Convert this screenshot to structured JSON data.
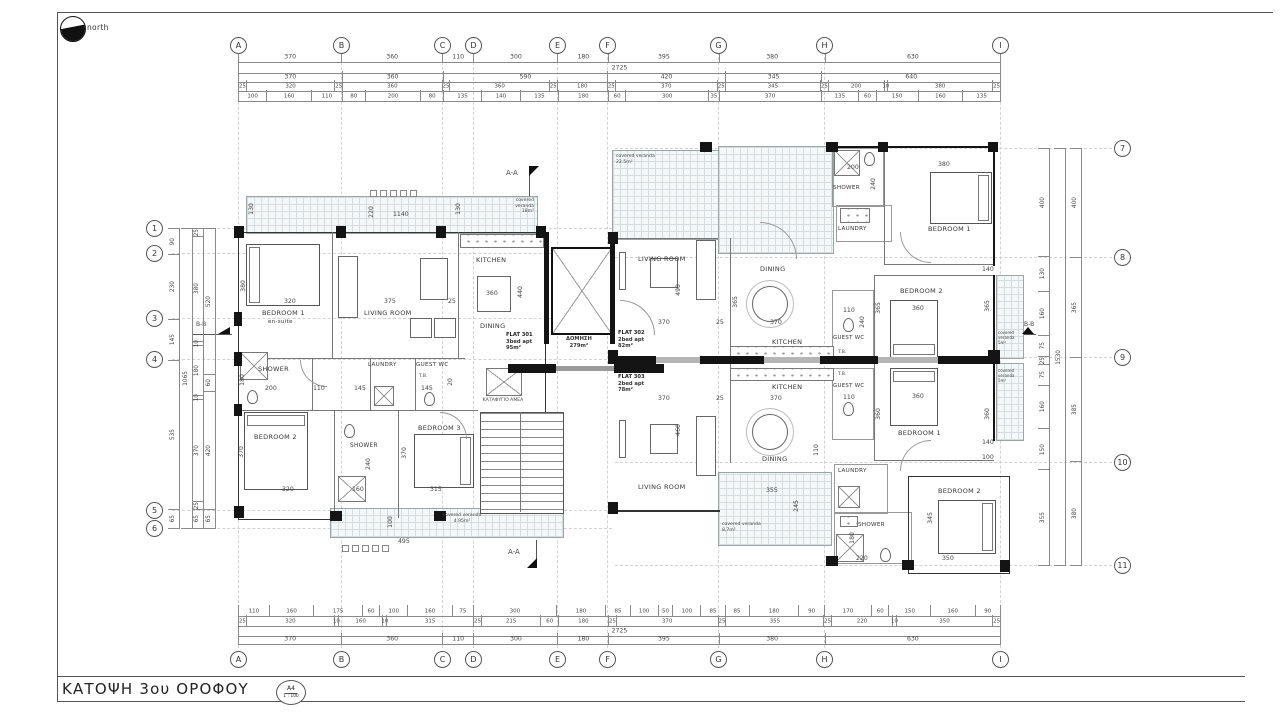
{
  "sheet": {
    "title": "ΚΑΤΟΨΗ 3ου ΟΡΟΦΟΥ",
    "paper": "A4",
    "scale": "1 : 100",
    "north": "north"
  },
  "grid": {
    "cols": [
      "A",
      "B",
      "C",
      "D",
      "E",
      "F",
      "G",
      "H",
      "I"
    ],
    "rows_left": [
      "1",
      "2",
      "3",
      "4",
      "5",
      "6"
    ],
    "rows_right": [
      "7",
      "8",
      "9",
      "10",
      "11"
    ]
  },
  "dims": {
    "top": {
      "grid": [
        370,
        360,
        110,
        300,
        180,
        395,
        380,
        630
      ],
      "overall": "2725",
      "chain2": [
        370,
        360,
        590,
        420,
        345,
        640
      ],
      "chain3": [
        25,
        320,
        25,
        360,
        25,
        360,
        25,
        180,
        25,
        370,
        25,
        345,
        25,
        200,
        10,
        380,
        25
      ],
      "chain4": [
        100,
        160,
        110,
        80,
        200,
        80,
        135,
        140,
        135,
        180,
        60,
        300,
        35,
        370,
        135,
        60,
        150,
        160,
        135
      ]
    },
    "bottom": {
      "chain1": [
        110,
        160,
        175,
        60,
        100,
        160,
        75,
        300,
        180,
        85,
        100,
        50,
        100,
        85,
        85,
        180,
        90,
        170,
        60,
        150,
        160,
        90
      ],
      "chain2": [
        25,
        320,
        10,
        160,
        10,
        315,
        25,
        215,
        60,
        180,
        25,
        370,
        25,
        355,
        25,
        220,
        10,
        350,
        25
      ],
      "overall": "2725",
      "grid": [
        370,
        360,
        110,
        300,
        180,
        395,
        380,
        630
      ]
    },
    "left": {
      "outer": [
        90,
        230,
        145,
        535,
        65
      ],
      "overall": "1065",
      "mid": [
        25,
        380,
        10,
        180,
        10,
        370,
        25,
        65
      ],
      "inner": [
        520,
        60,
        420,
        65
      ]
    },
    "right": {
      "inner": [
        400,
        130,
        160,
        75,
        25,
        75,
        160,
        150,
        355
      ],
      "overall": "1530",
      "outer": [
        400,
        365,
        385,
        380
      ]
    }
  },
  "sections": {
    "aa": "A-A",
    "bb": "B-B"
  },
  "flats": {
    "f301": {
      "name": "FLAT 301",
      "type": "3bed apt",
      "area": "95m²"
    },
    "f302": {
      "name": "FLAT 302",
      "type": "2bed apt",
      "area": "82m²"
    },
    "f303": {
      "name": "FLAT 303",
      "type": "2bed apt",
      "area": "78m²"
    },
    "common": {
      "name": "ΔΟΜΗΣΗ",
      "area": "279m²"
    },
    "shelter": "ΚΑΤΑΦΥΓΙΟ ΑΜΕΑ"
  },
  "rooms": {
    "bedroom1": "BEDROOM 1",
    "ensuite": "en-suite",
    "bedroom2": "BEDROOM 2",
    "bedroom3": "BEDROOM 3",
    "living": "LIVING ROOM",
    "kitchen": "KITCHEN",
    "dining": "DINING",
    "shower": "SHOWER",
    "laundry": "LAUNDRY",
    "guestwc": "GUEST WC",
    "tb": "T.B.",
    "veranda": "covered veranda"
  },
  "verandas": {
    "v301top": "18m²",
    "v301bot": "4.95m²",
    "v302top": "22.5m²",
    "v302r": "5m²",
    "v303r": "5m²",
    "v303bot": "8,7m²"
  },
  "d": {
    "v130": "130",
    "v1140": "1140",
    "v220": "220",
    "b1w": "320",
    "b1h": "380",
    "liv": "375",
    "g25": "25",
    "kt": "360",
    "kh": "440",
    "sh1h": "180",
    "sh1w": "200",
    "p110": "110",
    "p145": "145",
    "wc145": "145",
    "wc20": "20",
    "b2w": "320",
    "b2h": "370",
    "shmh": "240",
    "shmw": "160",
    "b3w": "315",
    "b3h": "370",
    "vb100": "100",
    "vb495": "495",
    "f2shw": "200",
    "f2shh": "240",
    "f2b1": "380",
    "f2livh": "490",
    "f2livw": "370",
    "f2din": "370",
    "f2dinh": "365",
    "f2wcw": "110",
    "f2wch": "240",
    "f2b2w": "360",
    "f2b2h": "365",
    "f2r140": "140",
    "f2r365": "365",
    "f3livh": "460",
    "f3din": "370",
    "f3wcw": "110",
    "f3b1": "360",
    "f3b1h": "360",
    "f3r140": "140",
    "f3r100": "100",
    "f3verw": "355",
    "f3verh": "245",
    "f3shh": "180",
    "f3shw": "220",
    "f3b2h": "345",
    "f3b2w": "350",
    "f3r360": "360",
    "d110v": "110"
  }
}
